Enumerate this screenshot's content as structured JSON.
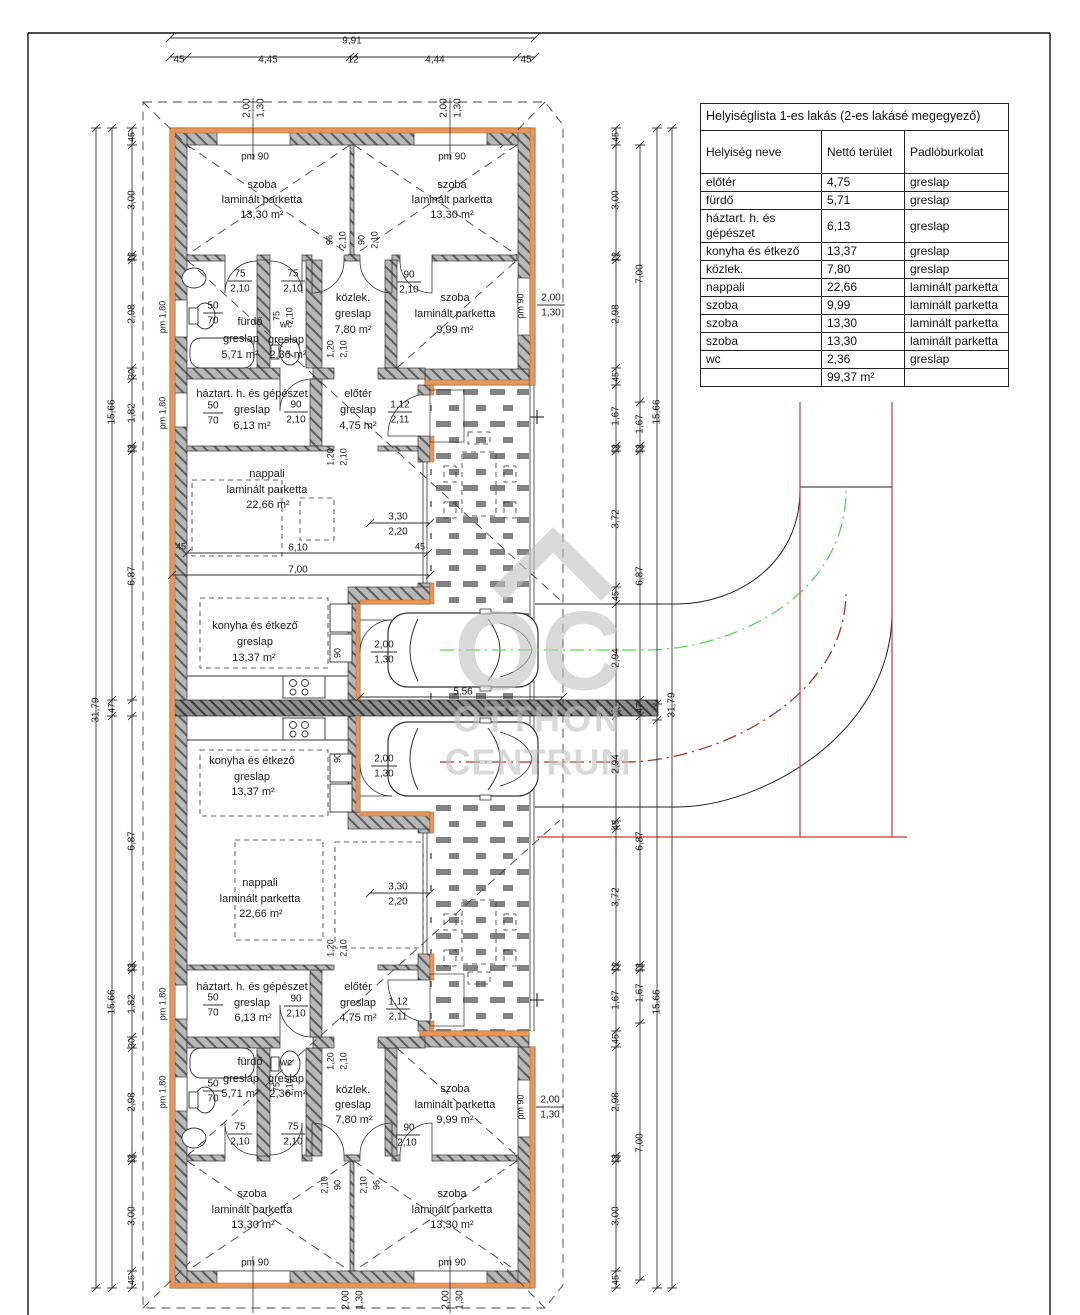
{
  "room_table": {
    "title": "Helyiséglista 1-es lakás (2-es lakásé megegyező)",
    "columns": [
      "Helyiség neve",
      "Nettó terület",
      "Padlóburkolat"
    ],
    "rows": [
      [
        "előtér",
        "4,75",
        "greslap"
      ],
      [
        "fürdő",
        "5,71",
        "greslap"
      ],
      [
        "háztart. h. és gépészet",
        "6,13",
        "greslap"
      ],
      [
        "konyha és étkező",
        "13,37",
        "greslap"
      ],
      [
        "közlek.",
        "7,80",
        "greslap"
      ],
      [
        "nappali",
        "22,66",
        "laminált parketta"
      ],
      [
        "szoba",
        "9,99",
        "laminált parketta"
      ],
      [
        "szoba",
        "13,30",
        "laminált parketta"
      ],
      [
        "szoba",
        "13,30",
        "laminált parketta"
      ],
      [
        "wc",
        "2,36",
        "greslap"
      ],
      [
        "",
        "99,37 m²",
        ""
      ]
    ]
  },
  "watermark": {
    "logo": "OC",
    "line1": "OTTHON",
    "line2": "CENTRUM"
  },
  "colors": {
    "wall_gray": "#b8b8b8",
    "insulation_orange": "#e8965a",
    "boundary_red": "#cc3333",
    "route_green": "#5cd65c",
    "route_darkred": "#a03a2a",
    "watermark_gray": "#c0c0c0"
  },
  "plan_labels": [
    {
      "t": "9,91",
      "x": 352,
      "y": 41,
      "s": 10
    },
    {
      "t": "45",
      "x": 179,
      "y": 60,
      "s": 10
    },
    {
      "t": "4,45",
      "x": 268,
      "y": 60,
      "s": 10
    },
    {
      "t": "12",
      "x": 353,
      "y": 60,
      "s": 10
    },
    {
      "t": "4,44",
      "x": 435,
      "y": 60,
      "s": 10
    },
    {
      "t": "45",
      "x": 526,
      "y": 60,
      "s": 10
    },
    {
      "t": "2,00",
      "x": 247,
      "y": 108,
      "r": -90,
      "s": 10
    },
    {
      "t": "1,30",
      "x": 261,
      "y": 108,
      "r": -90,
      "s": 10
    },
    {
      "t": "2,00",
      "x": 444,
      "y": 108,
      "r": -90,
      "s": 10
    },
    {
      "t": "1,30",
      "x": 458,
      "y": 108,
      "r": -90,
      "s": 10
    },
    {
      "t": "pm 90",
      "x": 255,
      "y": 157,
      "s": 10
    },
    {
      "t": "pm 90",
      "x": 452,
      "y": 157,
      "s": 10
    },
    {
      "t": "szoba",
      "x": 262,
      "y": 185
    },
    {
      "t": "laminált parketta",
      "x": 262,
      "y": 200
    },
    {
      "t": "13,30 m²",
      "x": 262,
      "y": 215
    },
    {
      "t": "szoba",
      "x": 452,
      "y": 185
    },
    {
      "t": "laminált parketta",
      "x": 452,
      "y": 200
    },
    {
      "t": "13,30 m²",
      "x": 452,
      "y": 215
    },
    {
      "t": "96",
      "x": 330,
      "y": 240,
      "r": -90,
      "s": 9
    },
    {
      "t": "2,10",
      "x": 343,
      "y": 240,
      "r": -90,
      "s": 9
    },
    {
      "t": "90",
      "x": 362,
      "y": 240,
      "r": -90,
      "s": 9
    },
    {
      "t": "2,10",
      "x": 375,
      "y": 240,
      "r": -90,
      "s": 9
    },
    {
      "t": "75",
      "x": 240,
      "y": 274,
      "s": 10
    },
    {
      "t": "2,10",
      "x": 240,
      "y": 289,
      "s": 10
    },
    {
      "t": "75",
      "x": 293,
      "y": 274,
      "s": 10
    },
    {
      "t": "2,10",
      "x": 293,
      "y": 289,
      "s": 10
    },
    {
      "t": "90",
      "x": 409,
      "y": 275,
      "s": 10
    },
    {
      "t": "2,10",
      "x": 409,
      "y": 290,
      "s": 10
    },
    {
      "t": "fürdő",
      "x": 250,
      "y": 322
    },
    {
      "t": "greslap",
      "x": 241,
      "y": 339
    },
    {
      "t": "5,71 m²",
      "x": 240,
      "y": 355
    },
    {
      "t": "75",
      "x": 277,
      "y": 316,
      "r": -90,
      "s": 9
    },
    {
      "t": "2,10",
      "x": 290,
      "y": 316,
      "r": -90,
      "s": 9
    },
    {
      "t": "wc",
      "x": 286,
      "y": 325,
      "s": 10
    },
    {
      "t": "greslap",
      "x": 286,
      "y": 340
    },
    {
      "t": "2,36 m²",
      "x": 288,
      "y": 355
    },
    {
      "t": "közlek.",
      "x": 353,
      "y": 298
    },
    {
      "t": "greslap",
      "x": 353,
      "y": 314
    },
    {
      "t": "7,80 m²",
      "x": 353,
      "y": 330
    },
    {
      "t": "szoba",
      "x": 455,
      "y": 298
    },
    {
      "t": "laminált parketta",
      "x": 455,
      "y": 314
    },
    {
      "t": "9,99 m²",
      "x": 455,
      "y": 330
    },
    {
      "t": "50",
      "x": 213,
      "y": 306,
      "s": 10
    },
    {
      "t": "70",
      "x": 213,
      "y": 321,
      "s": 10
    },
    {
      "t": "pm 1,80",
      "x": 163,
      "y": 317,
      "r": -90,
      "s": 9
    },
    {
      "t": "pm 90",
      "x": 521,
      "y": 306,
      "r": -90,
      "s": 9
    },
    {
      "t": "2,00",
      "x": 551,
      "y": 298,
      "s": 10
    },
    {
      "t": "1,30",
      "x": 551,
      "y": 313,
      "s": 10
    },
    {
      "t": "háztart. h. és gépészet",
      "x": 252,
      "y": 394
    },
    {
      "t": "greslap",
      "x": 252,
      "y": 410
    },
    {
      "t": "6,13 m²",
      "x": 252,
      "y": 426
    },
    {
      "t": "50",
      "x": 213,
      "y": 406,
      "s": 10
    },
    {
      "t": "70",
      "x": 213,
      "y": 421,
      "s": 10
    },
    {
      "t": "pm 1,80",
      "x": 163,
      "y": 413,
      "r": -90,
      "s": 9
    },
    {
      "t": "90",
      "x": 296,
      "y": 405,
      "s": 10
    },
    {
      "t": "2,10",
      "x": 296,
      "y": 420,
      "s": 10
    },
    {
      "t": "előtér",
      "x": 358,
      "y": 394
    },
    {
      "t": "greslap",
      "x": 358,
      "y": 410
    },
    {
      "t": "4,75 m²",
      "x": 358,
      "y": 426
    },
    {
      "t": "1,12",
      "x": 400,
      "y": 405,
      "s": 10
    },
    {
      "t": "2,11",
      "x": 400,
      "y": 420,
      "s": 10
    },
    {
      "t": "1,20",
      "x": 331,
      "y": 349,
      "r": -90,
      "s": 9
    },
    {
      "t": "2,10",
      "x": 344,
      "y": 349,
      "r": -90,
      "s": 9
    },
    {
      "t": "1,20",
      "x": 331,
      "y": 457,
      "r": -90,
      "s": 9
    },
    {
      "t": "2,10",
      "x": 344,
      "y": 457,
      "r": -90,
      "s": 9
    },
    {
      "t": "nappali",
      "x": 267,
      "y": 474
    },
    {
      "t": "laminált parketta",
      "x": 267,
      "y": 490
    },
    {
      "t": "22,66 m²",
      "x": 268,
      "y": 505
    },
    {
      "t": "3,30",
      "x": 398,
      "y": 517,
      "s": 10
    },
    {
      "t": "2,20",
      "x": 398,
      "y": 532,
      "s": 10
    },
    {
      "t": "45",
      "x": 181,
      "y": 547,
      "s": 9
    },
    {
      "t": "6,10",
      "x": 298,
      "y": 548,
      "s": 10
    },
    {
      "t": "45",
      "x": 420,
      "y": 547,
      "s": 9
    },
    {
      "t": "7,00",
      "x": 298,
      "y": 570,
      "s": 10
    },
    {
      "t": "konyha és étkező",
      "x": 255,
      "y": 626
    },
    {
      "t": "greslap",
      "x": 255,
      "y": 642
    },
    {
      "t": "13,37 m²",
      "x": 254,
      "y": 658
    },
    {
      "t": "90",
      "x": 338,
      "y": 653,
      "r": -90,
      "s": 9
    },
    {
      "t": "2,00",
      "x": 384,
      "y": 645,
      "s": 10
    },
    {
      "t": "1,30",
      "x": 384,
      "y": 660,
      "s": 10
    },
    {
      "t": "5,56",
      "x": 463,
      "y": 692,
      "s": 10
    },
    {
      "t": "konyha és étkező",
      "x": 252,
      "y": 761
    },
    {
      "t": "greslap",
      "x": 252,
      "y": 777
    },
    {
      "t": "13,37 m²",
      "x": 253,
      "y": 792
    },
    {
      "t": "90",
      "x": 338,
      "y": 758,
      "r": -90,
      "s": 9
    },
    {
      "t": "2,00",
      "x": 384,
      "y": 759,
      "s": 10
    },
    {
      "t": "1,30",
      "x": 384,
      "y": 774,
      "s": 10
    },
    {
      "t": "nappali",
      "x": 260,
      "y": 883
    },
    {
      "t": "laminált parketta",
      "x": 260,
      "y": 899
    },
    {
      "t": "22,66 m²",
      "x": 261,
      "y": 914
    },
    {
      "t": "3,30",
      "x": 398,
      "y": 887,
      "s": 10
    },
    {
      "t": "2,20",
      "x": 398,
      "y": 902,
      "s": 10
    },
    {
      "t": "1,20",
      "x": 331,
      "y": 948,
      "r": -90,
      "s": 9
    },
    {
      "t": "2,10",
      "x": 344,
      "y": 948,
      "r": -90,
      "s": 9
    },
    {
      "t": "1,20",
      "x": 331,
      "y": 1061,
      "r": -90,
      "s": 9
    },
    {
      "t": "2,10",
      "x": 344,
      "y": 1061,
      "r": -90,
      "s": 9
    },
    {
      "t": "háztart. h. és gépészet",
      "x": 252,
      "y": 987
    },
    {
      "t": "greslap",
      "x": 252,
      "y": 1003
    },
    {
      "t": "6,13 m²",
      "x": 253,
      "y": 1018
    },
    {
      "t": "50",
      "x": 213,
      "y": 998,
      "s": 10
    },
    {
      "t": "70",
      "x": 213,
      "y": 1013,
      "s": 10
    },
    {
      "t": "pm 1,80",
      "x": 163,
      "y": 1004,
      "r": -90,
      "s": 9
    },
    {
      "t": "90",
      "x": 296,
      "y": 999,
      "s": 10
    },
    {
      "t": "2,10",
      "x": 296,
      "y": 1014,
      "s": 10
    },
    {
      "t": "előtér",
      "x": 358,
      "y": 987
    },
    {
      "t": "greslap",
      "x": 358,
      "y": 1003
    },
    {
      "t": "4,75 m²",
      "x": 358,
      "y": 1018
    },
    {
      "t": "1,12",
      "x": 398,
      "y": 1002,
      "s": 10
    },
    {
      "t": "2,11",
      "x": 398,
      "y": 1017,
      "s": 10
    },
    {
      "t": "fürdő",
      "x": 250,
      "y": 1062
    },
    {
      "t": "greslap",
      "x": 241,
      "y": 1079
    },
    {
      "t": "5,71 m²",
      "x": 240,
      "y": 1094
    },
    {
      "t": "50",
      "x": 213,
      "y": 1084,
      "s": 10
    },
    {
      "t": "70",
      "x": 213,
      "y": 1099,
      "s": 10
    },
    {
      "t": "pm 1,80",
      "x": 163,
      "y": 1092,
      "r": -90,
      "s": 9
    },
    {
      "t": "wc",
      "x": 286,
      "y": 1063,
      "s": 10
    },
    {
      "t": "greslap",
      "x": 286,
      "y": 1079
    },
    {
      "t": "2,36 m²",
      "x": 288,
      "y": 1094
    },
    {
      "t": "75",
      "x": 277,
      "y": 1087,
      "r": -90,
      "s": 9
    },
    {
      "t": "2,10",
      "x": 290,
      "y": 1087,
      "r": -90,
      "s": 9
    },
    {
      "t": "közlek.",
      "x": 353,
      "y": 1090
    },
    {
      "t": "greslap",
      "x": 353,
      "y": 1105
    },
    {
      "t": "7,80 m²",
      "x": 354,
      "y": 1120
    },
    {
      "t": "szoba",
      "x": 455,
      "y": 1089
    },
    {
      "t": "laminált parketta",
      "x": 455,
      "y": 1105
    },
    {
      "t": "9,99 m²",
      "x": 455,
      "y": 1120
    },
    {
      "t": "pm 90",
      "x": 521,
      "y": 1107,
      "r": -90,
      "s": 9
    },
    {
      "t": "2,00",
      "x": 550,
      "y": 1100,
      "s": 10
    },
    {
      "t": "1,30",
      "x": 550,
      "y": 1115,
      "s": 10
    },
    {
      "t": "75",
      "x": 240,
      "y": 1127,
      "s": 10
    },
    {
      "t": "2,10",
      "x": 240,
      "y": 1142,
      "s": 10
    },
    {
      "t": "75",
      "x": 293,
      "y": 1127,
      "s": 10
    },
    {
      "t": "2,10",
      "x": 293,
      "y": 1142,
      "s": 10
    },
    {
      "t": "90",
      "x": 409,
      "y": 1128,
      "s": 10
    },
    {
      "t": "2,10",
      "x": 407,
      "y": 1143,
      "s": 10
    },
    {
      "t": "2,10",
      "x": 325,
      "y": 1185,
      "r": -90,
      "s": 9
    },
    {
      "t": "90",
      "x": 338,
      "y": 1185,
      "r": -90,
      "s": 9
    },
    {
      "t": "2,10",
      "x": 364,
      "y": 1185,
      "r": -90,
      "s": 9
    },
    {
      "t": "96",
      "x": 377,
      "y": 1185,
      "r": -90,
      "s": 9
    },
    {
      "t": "szoba",
      "x": 252,
      "y": 1194
    },
    {
      "t": "laminált parketta",
      "x": 252,
      "y": 1210
    },
    {
      "t": "13,30 m²",
      "x": 253,
      "y": 1225
    },
    {
      "t": "pm 90",
      "x": 255,
      "y": 1263,
      "s": 10
    },
    {
      "t": "szoba",
      "x": 452,
      "y": 1194
    },
    {
      "t": "laminált parketta",
      "x": 452,
      "y": 1210
    },
    {
      "t": "13,30 m²",
      "x": 452,
      "y": 1225
    },
    {
      "t": "pm 90",
      "x": 452,
      "y": 1263,
      "s": 10
    },
    {
      "t": "2,00",
      "x": 346,
      "y": 1300,
      "r": -90,
      "s": 10
    },
    {
      "t": "1,30",
      "x": 360,
      "y": 1300,
      "r": -90,
      "s": 10
    },
    {
      "t": "2,00",
      "x": 446,
      "y": 1300,
      "r": -90,
      "s": 10
    },
    {
      "t": "1,30",
      "x": 460,
      "y": 1300,
      "r": -90,
      "s": 10
    },
    {
      "t": "31,79",
      "x": 96,
      "y": 710,
      "r": -90,
      "s": 10
    },
    {
      "t": "15,66",
      "x": 112,
      "y": 412,
      "r": -90,
      "s": 10
    },
    {
      "t": "47",
      "x": 112,
      "y": 708,
      "r": -90,
      "s": 9
    },
    {
      "t": "15,66",
      "x": 112,
      "y": 1002,
      "r": -90,
      "s": 10
    },
    {
      "t": "45",
      "x": 132,
      "y": 137,
      "r": -90,
      "s": 9
    },
    {
      "t": "3,00",
      "x": 132,
      "y": 200,
      "r": -90,
      "s": 10
    },
    {
      "t": "12",
      "x": 132,
      "y": 257,
      "r": -90,
      "s": 9
    },
    {
      "t": "2,98",
      "x": 132,
      "y": 314,
      "r": -90,
      "s": 10
    },
    {
      "t": "30",
      "x": 132,
      "y": 374,
      "r": -90,
      "s": 9
    },
    {
      "t": "1,82",
      "x": 132,
      "y": 413,
      "r": -90,
      "s": 10
    },
    {
      "t": "12",
      "x": 132,
      "y": 449,
      "r": -90,
      "s": 9
    },
    {
      "t": "6,87",
      "x": 132,
      "y": 576,
      "r": -90,
      "s": 10
    },
    {
      "t": "6,87",
      "x": 132,
      "y": 841,
      "r": -90,
      "s": 10
    },
    {
      "t": "12",
      "x": 132,
      "y": 968,
      "r": -90,
      "s": 9
    },
    {
      "t": "1,82",
      "x": 132,
      "y": 1004,
      "r": -90,
      "s": 10
    },
    {
      "t": "30",
      "x": 132,
      "y": 1043,
      "r": -90,
      "s": 9
    },
    {
      "t": "2,98",
      "x": 132,
      "y": 1102,
      "r": -90,
      "s": 10
    },
    {
      "t": "12",
      "x": 132,
      "y": 1159,
      "r": -90,
      "s": 9
    },
    {
      "t": "3,00",
      "x": 132,
      "y": 1216,
      "r": -90,
      "s": 10
    },
    {
      "t": "45",
      "x": 132,
      "y": 1280,
      "r": -90,
      "s": 9
    },
    {
      "t": "45",
      "x": 616,
      "y": 137,
      "r": -90,
      "s": 9
    },
    {
      "t": "3,00",
      "x": 616,
      "y": 200,
      "r": -90,
      "s": 10
    },
    {
      "t": "12",
      "x": 616,
      "y": 257,
      "r": -90,
      "s": 9
    },
    {
      "t": "2,98",
      "x": 616,
      "y": 314,
      "r": -90,
      "s": 10
    },
    {
      "t": "45",
      "x": 616,
      "y": 377,
      "r": -90,
      "s": 9
    },
    {
      "t": "1,67",
      "x": 616,
      "y": 416,
      "r": -90,
      "s": 10
    },
    {
      "t": "12",
      "x": 616,
      "y": 449,
      "r": -90,
      "s": 9
    },
    {
      "t": "3,72",
      "x": 616,
      "y": 519,
      "r": -90,
      "s": 10
    },
    {
      "t": "45",
      "x": 616,
      "y": 596,
      "r": -90,
      "s": 9
    },
    {
      "t": "2,94",
      "x": 616,
      "y": 658,
      "r": -90,
      "s": 10
    },
    {
      "t": "2,94",
      "x": 616,
      "y": 764,
      "r": -90,
      "s": 10
    },
    {
      "t": "45",
      "x": 616,
      "y": 825,
      "r": -90,
      "s": 9
    },
    {
      "t": "3,72",
      "x": 616,
      "y": 897,
      "r": -90,
      "s": 10
    },
    {
      "t": "12",
      "x": 616,
      "y": 967,
      "r": -90,
      "s": 9
    },
    {
      "t": "1,67",
      "x": 616,
      "y": 1000,
      "r": -90,
      "s": 10
    },
    {
      "t": "45",
      "x": 616,
      "y": 1039,
      "r": -90,
      "s": 9
    },
    {
      "t": "2,98",
      "x": 616,
      "y": 1102,
      "r": -90,
      "s": 10
    },
    {
      "t": "12",
      "x": 616,
      "y": 1159,
      "r": -90,
      "s": 9
    },
    {
      "t": "3,00",
      "x": 616,
      "y": 1216,
      "r": -90,
      "s": 10
    },
    {
      "t": "45",
      "x": 616,
      "y": 1280,
      "r": -90,
      "s": 9
    },
    {
      "t": "7,00",
      "x": 640,
      "y": 274,
      "r": -90,
      "s": 10
    },
    {
      "t": "1,67",
      "x": 640,
      "y": 424,
      "r": -90,
      "s": 10
    },
    {
      "t": "12",
      "x": 640,
      "y": 449,
      "r": -90,
      "s": 9
    },
    {
      "t": "6,87",
      "x": 640,
      "y": 576,
      "r": -90,
      "s": 10
    },
    {
      "t": "47",
      "x": 640,
      "y": 708,
      "r": -90,
      "s": 9
    },
    {
      "t": "6,87",
      "x": 640,
      "y": 841,
      "r": -90,
      "s": 10
    },
    {
      "t": "12",
      "x": 640,
      "y": 968,
      "r": -90,
      "s": 9
    },
    {
      "t": "1,67",
      "x": 640,
      "y": 993,
      "r": -90,
      "s": 10
    },
    {
      "t": "7,00",
      "x": 640,
      "y": 1143,
      "r": -90,
      "s": 10
    },
    {
      "t": "15,66",
      "x": 657,
      "y": 412,
      "r": -90,
      "s": 10
    },
    {
      "t": "15,66",
      "x": 657,
      "y": 1002,
      "r": -90,
      "s": 10
    },
    {
      "t": "31,79",
      "x": 672,
      "y": 705,
      "r": -90,
      "s": 10
    }
  ]
}
